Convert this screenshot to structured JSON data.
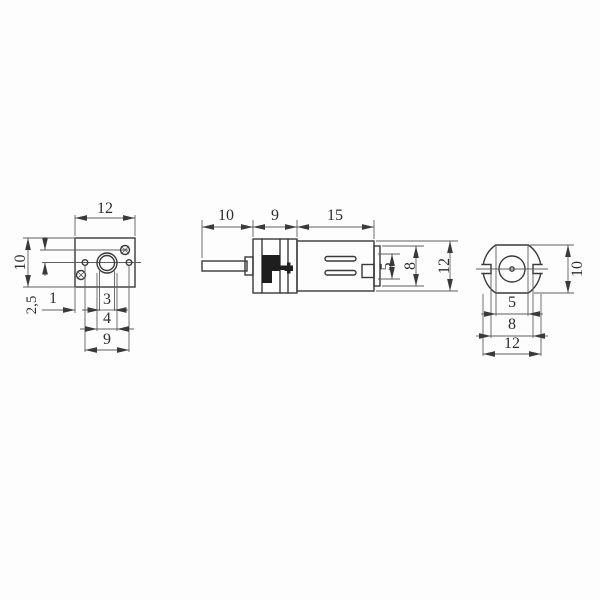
{
  "title": "micro gear motor dimension drawing",
  "units_note": "",
  "colors": {
    "background": "#fdfdfd",
    "line": "#3a3a3a",
    "thin_line": "#5f5f5f",
    "text": "#2d2d2d",
    "ink": "#1e1e1e"
  },
  "views": {
    "front": {
      "width": "12",
      "height": "10",
      "offset": "2,5",
      "edge": "1",
      "shaft": "3",
      "bushing": "4",
      "holes": "9"
    },
    "side": {
      "shaft_len": "10",
      "gear_len": "9",
      "motor_len": "15",
      "h5": "5",
      "h8": "8",
      "h12": "12"
    },
    "rear": {
      "height": "10",
      "boss": "5",
      "notch": "8",
      "width": "12"
    }
  }
}
